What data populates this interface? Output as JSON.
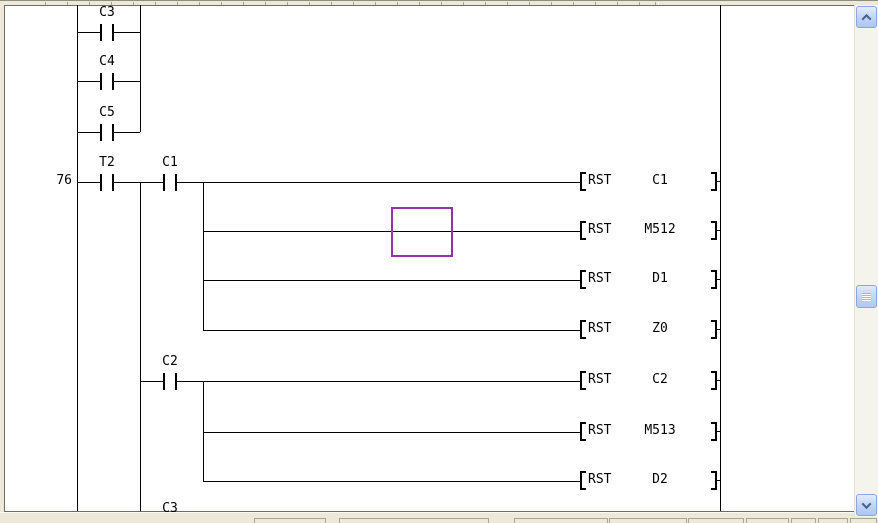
{
  "window": {
    "kind": "plc-ladder-editor-viewport"
  },
  "ladder": {
    "step": {
      "label": "76",
      "x_right_edge": 72,
      "row_y": 182
    },
    "rails": [
      {
        "name": "left-power-rail",
        "x": 77,
        "y1": 5,
        "y2": 511
      },
      {
        "name": "right-power-rail",
        "x": 720,
        "y1": 5,
        "y2": 511
      }
    ],
    "verticals": [
      {
        "x": 140,
        "y1": 5,
        "y2": 132
      },
      {
        "x": 140,
        "y1": 182,
        "y2": 511
      },
      {
        "x": 203,
        "y1": 182,
        "y2": 330
      },
      {
        "x": 203,
        "y1": 381,
        "y2": 481
      }
    ],
    "wires": [
      {
        "y": 32,
        "x1": 77,
        "x2": 140
      },
      {
        "y": 81,
        "x1": 77,
        "x2": 140
      },
      {
        "y": 132,
        "x1": 77,
        "x2": 140
      },
      {
        "y": 182,
        "x1": 77,
        "x2": 581
      },
      {
        "y": 231,
        "x1": 203,
        "x2": 581
      },
      {
        "y": 280,
        "x1": 203,
        "x2": 581
      },
      {
        "y": 330,
        "x1": 203,
        "x2": 581
      },
      {
        "y": 381,
        "x1": 140,
        "x2": 581
      },
      {
        "y": 432,
        "x1": 203,
        "x2": 581
      },
      {
        "y": 481,
        "x1": 203,
        "x2": 581
      }
    ],
    "contacts": [
      {
        "label": "C3",
        "cx": 107,
        "y": 32
      },
      {
        "label": "C4",
        "cx": 107,
        "y": 81
      },
      {
        "label": "C5",
        "cx": 107,
        "y": 132
      },
      {
        "label": "T2",
        "cx": 107,
        "y": 182
      },
      {
        "label": "C1",
        "cx": 170,
        "y": 182
      },
      {
        "label": "C2",
        "cx": 170,
        "y": 381
      }
    ],
    "coils": [
      {
        "mnemonic": "RST",
        "operand": "C1",
        "y": 182
      },
      {
        "mnemonic": "RST",
        "operand": "M512",
        "y": 231
      },
      {
        "mnemonic": "RST",
        "operand": "D1",
        "y": 280
      },
      {
        "mnemonic": "RST",
        "operand": "Z0",
        "y": 330
      },
      {
        "mnemonic": "RST",
        "operand": "C2",
        "y": 381
      },
      {
        "mnemonic": "RST",
        "operand": "M513",
        "y": 432
      },
      {
        "mnemonic": "RST",
        "operand": "D2",
        "y": 481
      }
    ],
    "partial_label": {
      "text": "C3",
      "cx": 170,
      "top": 502
    },
    "cursor": {
      "x": 391,
      "y": 207,
      "w": 62,
      "h": 50,
      "color": "#9333A8"
    }
  },
  "scrollbar": {
    "orientation": "vertical",
    "up_icon": "chevron-up-icon",
    "down_icon": "chevron-down-icon",
    "thumb_top": 285,
    "thumb_height": 23
  },
  "status_bar": {
    "panes": [
      {
        "x": 254,
        "w": 72
      },
      {
        "x": 339,
        "w": 150
      },
      {
        "x": 514,
        "w": 94
      },
      {
        "x": 609,
        "w": 78
      },
      {
        "x": 688,
        "w": 56
      },
      {
        "x": 746,
        "w": 43
      },
      {
        "x": 791,
        "w": 25
      },
      {
        "x": 818,
        "w": 30
      },
      {
        "x": 850,
        "w": 27
      }
    ]
  },
  "colors": {
    "chrome": "#ECE9D8",
    "canvas": "#FFFFFF",
    "line": "#000000",
    "cursor": "#9333A8",
    "border_dark": "#6F6E62",
    "scroll_track": "#F5F4EC",
    "button_face": "#C6D6F7",
    "button_border": "#8AA6E4",
    "chevron": "#44618B"
  }
}
